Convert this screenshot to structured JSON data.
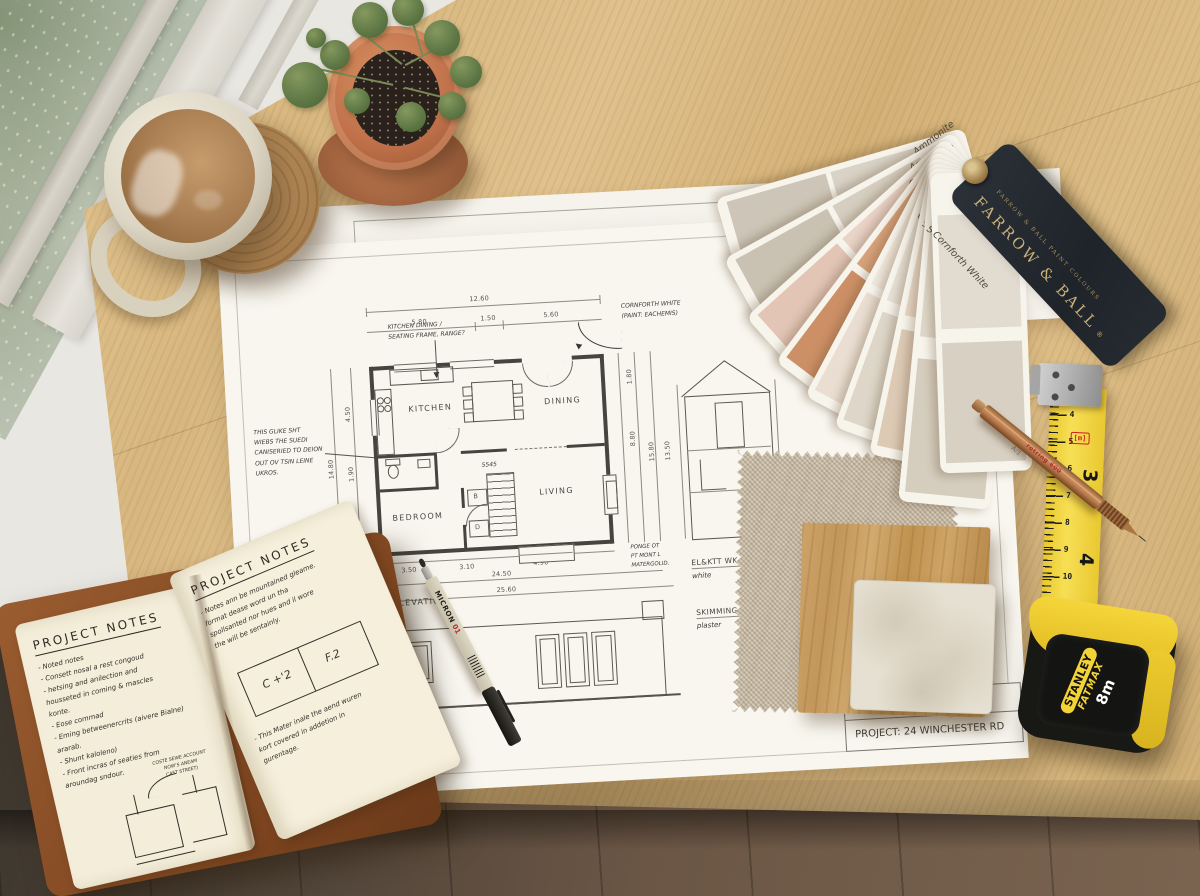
{
  "colors": {
    "desk_wood": "#dcbd8a",
    "floor_wood": "#6b5846",
    "paper": "#f8f6ef",
    "leather": "#8a5530",
    "terracotta": "#bf7248",
    "tape_yellow": "#f2d338",
    "tag_navy": "#262b31",
    "tag_gold": "#c9b078",
    "linen": "#c8bba6",
    "oak_sample": "#c79b5e",
    "stone_sample": "#e6e0d2"
  },
  "plan": {
    "rooms": [
      "KITCHEN",
      "DINING",
      "BEDROOM",
      "LIVING"
    ],
    "small_rooms": [
      "B",
      "D"
    ],
    "stair_label": "5545",
    "dims": {
      "top_total": "12.60",
      "top_segments": [
        "5.80",
        "1.50",
        "5.60"
      ],
      "left": [
        "4.50",
        "1.90"
      ],
      "left_outer": "14.80",
      "right": [
        "1.80",
        "8.80"
      ],
      "right_outer": [
        "15.80",
        "13.50"
      ],
      "bottom": [
        "3.50",
        "3.10",
        "4.90"
      ],
      "bottom_totals": [
        "24.50",
        "25.60"
      ]
    },
    "notes": {
      "kitchen": [
        "KITCHEN DINING /",
        "SEATING FRAME, RANGE?"
      ],
      "paint": [
        "CORNFORTH WHITE",
        "(PAINT: EACHEMIS)"
      ],
      "left": [
        "THIS GLIKE SHT",
        "WIEBS THE SUEDI",
        "CANISERIED TO DEION",
        "OUT OV TSIN LEINE",
        "UKROS."
      ],
      "corner": [
        "PONGE OT",
        "PT MONT L",
        "MATERGOLID."
      ],
      "materials": [
        "PA",
        "BLDA",
        "WDT R.",
        "LIMESTONE"
      ],
      "finishes": [
        {
          "title": "EL&KTT WK COV",
          "sub": "white"
        },
        {
          "title": "SKIMMING PLAST",
          "sub": "plaster"
        }
      ]
    },
    "elevation_label": "ELEVATION",
    "titleblock": {
      "scale": "SCALE  1:50",
      "project": "PROJECT: 24 WINCHESTER RD"
    }
  },
  "notebook": {
    "left": {
      "title": "PROJECT NOTES",
      "lines": [
        "- Noted notes",
        "   - Consett nosal a rest congoud",
        "      - hetsing and anilection and",
        "        housseted in coming & mascles",
        "        konte.",
        "- Eose commad",
        "   - Eming betweenercrits (aivere Bialne)",
        "      ararab.",
        "   - Shunt kaloleno)",
        "- Front incras of seaties from",
        "      aroundag sndour."
      ],
      "sketch_note": [
        "COSTE SEWE ACCOUNT",
        "NOW'S ANEAM",
        "CAST STREET)"
      ]
    },
    "right": {
      "title": "PROJECT NOTES",
      "lines": [
        "- Notes ann be mountained gleame.",
        "   format dease word un tha",
        "   spollsanted nor hues and il wore",
        "   the will be sentainly."
      ],
      "box_cells": [
        "C +'2",
        "F.2"
      ],
      "lines2": [
        "- This Mater inale the aend wuren",
        "   kort covered in addetion in",
        "   gurentage."
      ]
    }
  },
  "fan": {
    "cards": [
      {
        "name": "Ammonite",
        "c1": "#d9d3c7",
        "c2": "#cdc6b8"
      },
      {
        "name": "Ammonite",
        "c1": "#d6cfc1",
        "c2": "#c9c2b2"
      },
      {
        "name": "Calamine",
        "c1": "#ead3c7",
        "c2": "#e2c5b5"
      },
      {
        "name": "Calamine",
        "c1": "#d8a37b",
        "c2": "#cd9066"
      },
      {
        "name": "Calamine",
        "c1": "#f0e8dd",
        "c2": "#e9ded1"
      },
      {
        "name": "Cornforth White",
        "c1": "#e7e1d5",
        "c2": "#ded7c9"
      },
      {
        "name": "Setting Plaster",
        "c1": "#e6d6c4",
        "c2": "#ddcab5",
        "code": "A-8"
      },
      {
        "name": "Skimming Stone",
        "c1": "#dfd8ca",
        "c2": "#d5cdbd"
      },
      {
        "name": "Cornforth White",
        "c1": "#e2dcd0",
        "c2": "#d8d1c3",
        "code": "A/1"
      }
    ],
    "tag": {
      "brand": "FARROW & BALL",
      "reg": "®",
      "subtitle": "FARROW & BALL PAINT COLOURS"
    }
  },
  "tape": {
    "brand": "STANLEY",
    "series": "FATMAX",
    "size": "8m",
    "marker": "[m]",
    "cm_numbers": [
      "4",
      "5",
      "6",
      "7",
      "8",
      "9",
      "10",
      "11",
      "12",
      "13"
    ],
    "inch_numbers": [
      "3",
      "4",
      "5"
    ]
  },
  "pencil": {
    "brand": "rotring 600"
  },
  "pen": {
    "brand": "MICRON",
    "size": "01"
  }
}
